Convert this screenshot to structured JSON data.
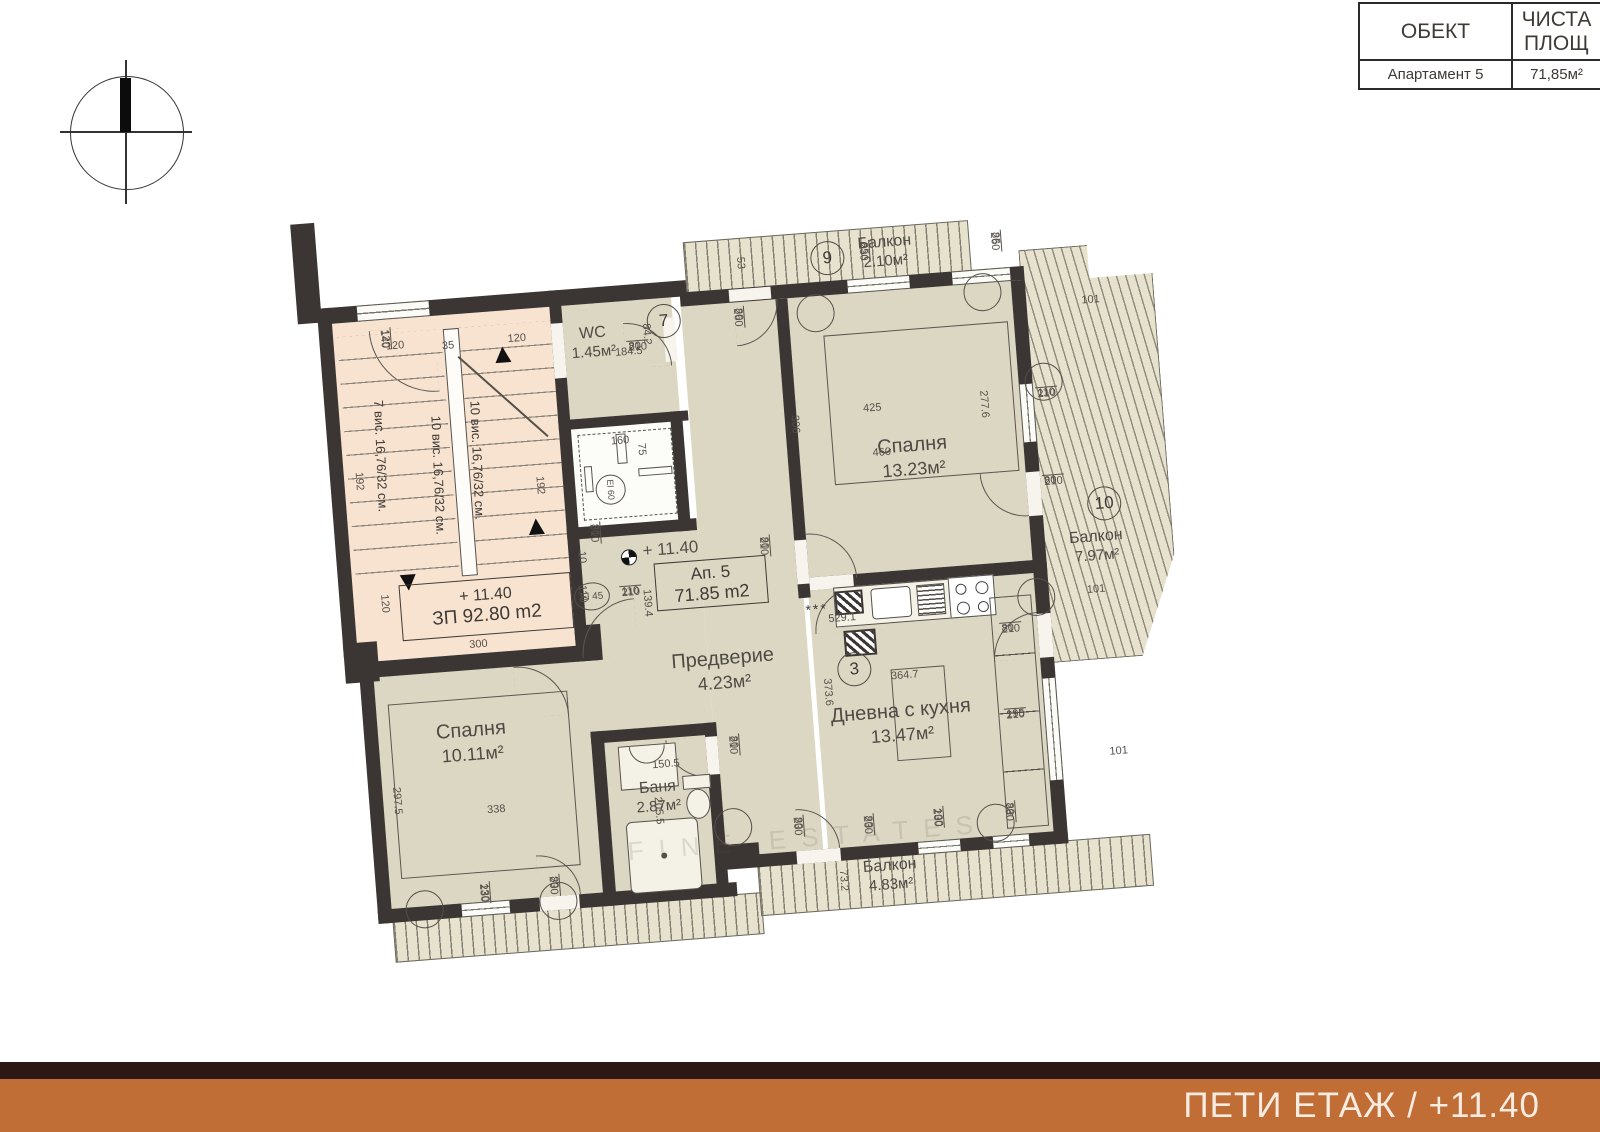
{
  "title_block": {
    "headers": [
      "ОБЕКТ",
      "ЧИСТА ПЛОЩ"
    ],
    "row": [
      "Апартамент 5",
      "71,85м²"
    ]
  },
  "footer": {
    "text": "ПЕТИ ЕТАЖ / +11.40",
    "bar_color": "#c06e36",
    "stripe_color": "#2e1813"
  },
  "watermark": "FINE ESTATES",
  "plan": {
    "rooms": {
      "stair": {
        "level": "+ 11.40",
        "area": "ЗП 92.80 m2",
        "runs": [
          "7 вис. 16,76/32 см.",
          "10 вис. 16,76/32 см.",
          "10 вис. 16,76/32 см."
        ]
      },
      "wc": {
        "name": "WC",
        "area": "1.45м²"
      },
      "bedroom1": {
        "name": "Спалня",
        "area": "13.23м²"
      },
      "bedroom2": {
        "name": "Спалня",
        "area": "10.11м²"
      },
      "living": {
        "name": "Дневна с кухня",
        "area": "13.47м²"
      },
      "hall": {
        "name": "Предверие",
        "area": "4.23м²"
      },
      "bath": {
        "name": "Баня",
        "area": "2.87м²"
      },
      "balcony_top": {
        "name": "Балкон",
        "area": "2.10м²"
      },
      "balcony_right": {
        "name": "Балкон",
        "area": "7.97м²"
      },
      "balcony_bottom": {
        "name": "Балкон",
        "area": "4.83м²"
      }
    },
    "apartment_box": {
      "line1": "Ап. 5",
      "line2": "71.85 m2"
    },
    "level_marker": "+ 11.40",
    "wc_dim": "184.5",
    "circles": {
      "c7": "7",
      "c9": "9",
      "c3": "3",
      "c10": "10",
      "el45": "El 45",
      "el60": "El 60"
    },
    "kitchen_stars": "***",
    "frac_labels": [
      {
        "t": "80",
        "b": "210"
      },
      {
        "t": "80",
        "b": "260"
      },
      {
        "t": "85",
        "b": "230"
      },
      {
        "t": "85",
        "b": "260"
      },
      {
        "t": "110",
        "b": "210"
      },
      {
        "t": "80",
        "b": "210"
      },
      {
        "t": "110",
        "b": "210"
      },
      {
        "t": "80",
        "b": "210"
      },
      {
        "t": "80",
        "b": "210"
      },
      {
        "t": "80",
        "b": "210"
      },
      {
        "t": "195",
        "b": "210"
      },
      {
        "t": "80",
        "b": "210"
      },
      {
        "t": "80",
        "b": "230"
      },
      {
        "t": "80",
        "b": "230"
      },
      {
        "t": "100",
        "b": "230"
      },
      {
        "t": "80",
        "b": "230"
      },
      {
        "t": "130",
        "b": "230"
      },
      {
        "t": "80",
        "b": "230"
      },
      {
        "t": "120",
        "b": "140"
      }
    ],
    "lin_dims": [
      "120",
      "35",
      "120",
      "192",
      "192",
      "120",
      "300",
      "110",
      "10",
      "184.5",
      "84.2",
      "160",
      "75",
      "425",
      "460",
      "306",
      "277.6",
      "139.4",
      "529.1",
      "373.6",
      "364.7",
      "338",
      "297.5",
      "150.5",
      "205.5",
      "53",
      "101",
      "101",
      "101",
      "73.2"
    ]
  }
}
